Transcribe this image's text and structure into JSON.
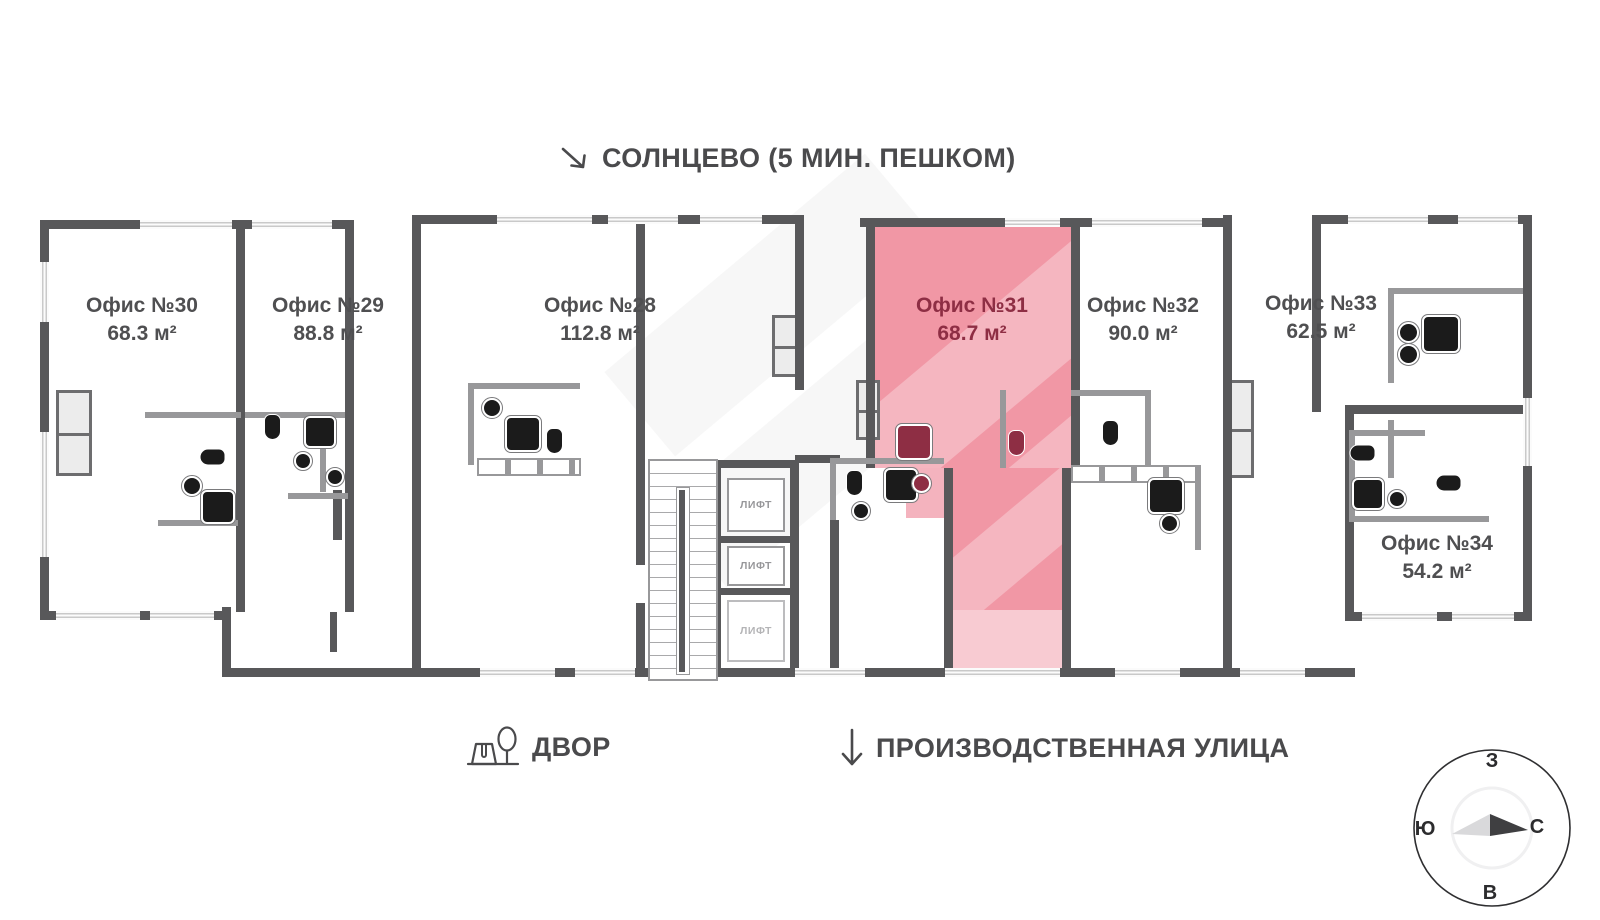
{
  "labels": {
    "top_direction": "СОЛНЦЕВО (5 МИН. ПЕШКОМ)",
    "courtyard": "ДВОР",
    "street": "ПРОИЗВОДСТВЕННАЯ УЛИЦА"
  },
  "offices": [
    {
      "name": "Офис №30",
      "area": "68.3 м²",
      "highlighted": false
    },
    {
      "name": "Офис №29",
      "area": "88.8 м²",
      "highlighted": false
    },
    {
      "name": "Офис №28",
      "area": "112.8 м²",
      "highlighted": false
    },
    {
      "name": "Офис №31",
      "area": "68.7 м²",
      "highlighted": true
    },
    {
      "name": "Офис №32",
      "area": "90.0 м²",
      "highlighted": false
    },
    {
      "name": "Офис №33",
      "area": "62.5 м²",
      "highlighted": false
    },
    {
      "name": "Офис №34",
      "area": "54.2 м²",
      "highlighted": false
    }
  ],
  "elevators": [
    {
      "label": "ЛИФТ"
    },
    {
      "label": "ЛИФТ"
    },
    {
      "label": "ЛИФТ"
    }
  ],
  "compass": {
    "top": "З",
    "right": "С",
    "bottom": "В",
    "left": "Ю"
  },
  "colors": {
    "wall": "#58585a",
    "wall_light": "#98989a",
    "window_pane": "#c9c9c9",
    "highlight": "#f197a5",
    "highlight_mid": "#f4b3be",
    "highlight_soft": "#f8cbd2",
    "accent": "#8e2e44",
    "text": "#4a4a4c",
    "label": "#4f4f51",
    "fixture": "#1b1b1b",
    "lift_text": "#97979a"
  }
}
